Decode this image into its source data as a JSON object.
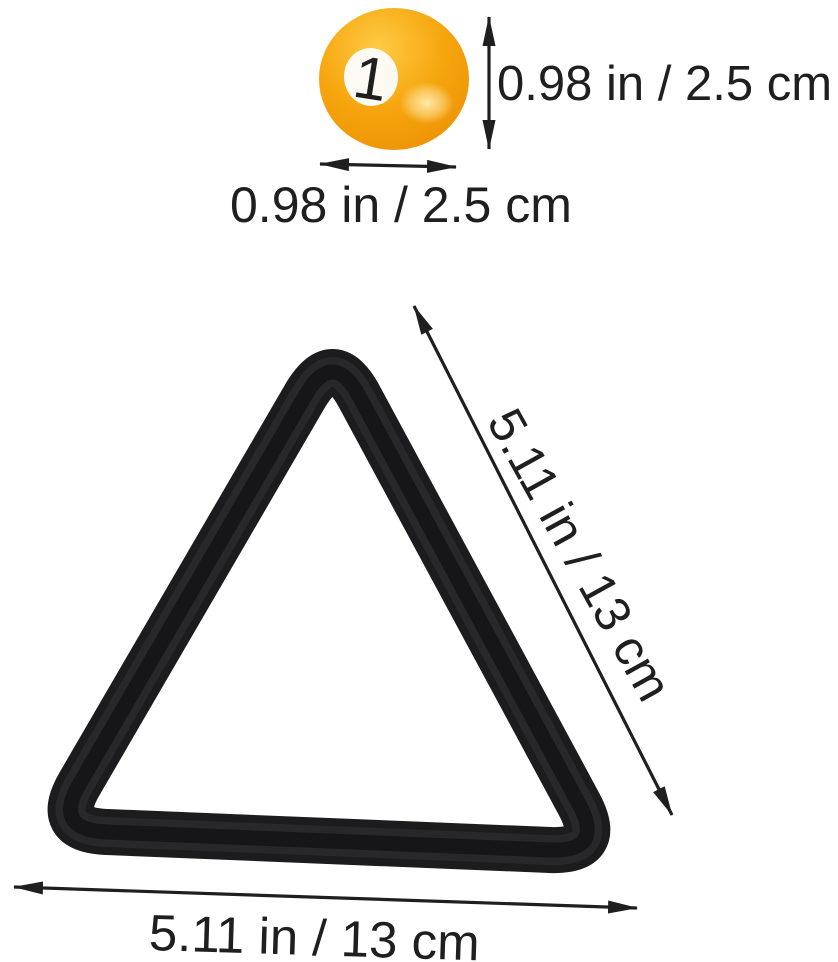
{
  "colors": {
    "annotation": "#1f1f1f",
    "rack_outer": "#1c1c1e",
    "rack_mid": "#28282b",
    "rack_core": "#161618",
    "ball_light": "#ffca45",
    "ball_main": "#f6a60e",
    "ball_dark": "#ee9305",
    "ball_rim": "#df8a06",
    "ball_highlight": "#ffedb0",
    "number_circle_center": "#fdfaf4",
    "number_circle_edge": "#eae1d2",
    "ball_number_color": "#1f1f1f"
  },
  "ball": {
    "number": "1",
    "height_label": "0.98 in / 2.5 cm",
    "width_label": "0.98 in / 2.5 cm"
  },
  "rack": {
    "side_label": "5.11 in / 13 cm",
    "bottom_label": "5.11 in / 13 cm"
  }
}
